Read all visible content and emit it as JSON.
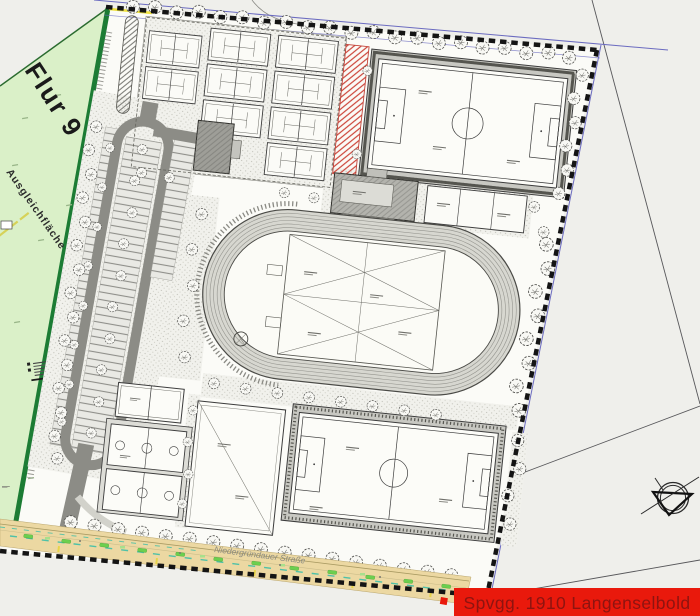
{
  "plan": {
    "parcel_label": "Flur 9",
    "compensation_label": "Ausgleichfläche",
    "street_label": "Niedergründauer Straße",
    "title_banner": "Spvgg. 1910 Langenselbold",
    "colors": {
      "parcel_green": "#daf0c8",
      "parcel_border_green": "#1c7c34",
      "street_tan": "#ecd8a2",
      "vegetation_green": "#6ccf4f",
      "utility_violet": "#6b6bc0",
      "teal_line": "#3fbfa8",
      "boundary_black": "#141414",
      "banner_red": "#e9190c",
      "banner_text_red": "#8e1410"
    },
    "icons": {
      "north_arrow": "north-arrow-icon",
      "tree": "tree-icon"
    }
  }
}
